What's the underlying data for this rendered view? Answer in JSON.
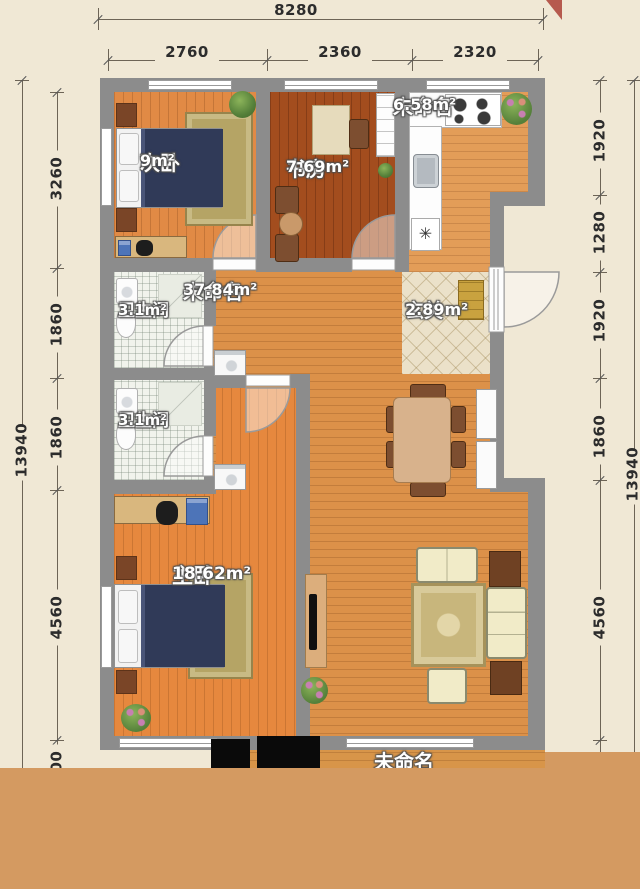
{
  "rooms": [
    {
      "id": "bedroom2",
      "name": "次卧",
      "area": "9m²"
    },
    {
      "id": "study",
      "name": "书房",
      "area": "7.69m²"
    },
    {
      "id": "kitchen",
      "name": "未命名",
      "area": "6.58m²"
    },
    {
      "id": "bath1",
      "name": "卫生间",
      "area": "3.1m²"
    },
    {
      "id": "living",
      "name": "未命名",
      "area": "37.84m²"
    },
    {
      "id": "hall",
      "name": "玄关",
      "area": "2.89m²"
    },
    {
      "id": "bath2",
      "name": "卫生间",
      "area": "3.1m²"
    },
    {
      "id": "master",
      "name": "主卧",
      "area": "18.62m²"
    },
    {
      "id": "balcony",
      "name": "未命名",
      "area": ""
    }
  ],
  "dimensions": {
    "top_overall": "8280",
    "top_segments": [
      "2760",
      "2360",
      "2320"
    ],
    "left_overall": "13940",
    "left_segments": [
      "3260",
      "1860",
      "1860",
      "4560",
      "2400"
    ],
    "right_overall": "13940",
    "right_segments": [
      "1920",
      "1280",
      "1920",
      "1860",
      "4560"
    ]
  },
  "symbols": {
    "dishwasher": "✳"
  },
  "colors": {
    "canvas": "#f0e8d5",
    "wall": "#8c8c8c",
    "band": "#d49a61",
    "living_floor": "#dc9149",
    "bedroom2_floor": "#e18a45",
    "study_floor": "#a34d1e",
    "kitchen_floor": "#e39d58",
    "master_floor": "#e6883e",
    "bath_tile": "#f1f3ec",
    "hall_tile": "#ebe1c9"
  }
}
